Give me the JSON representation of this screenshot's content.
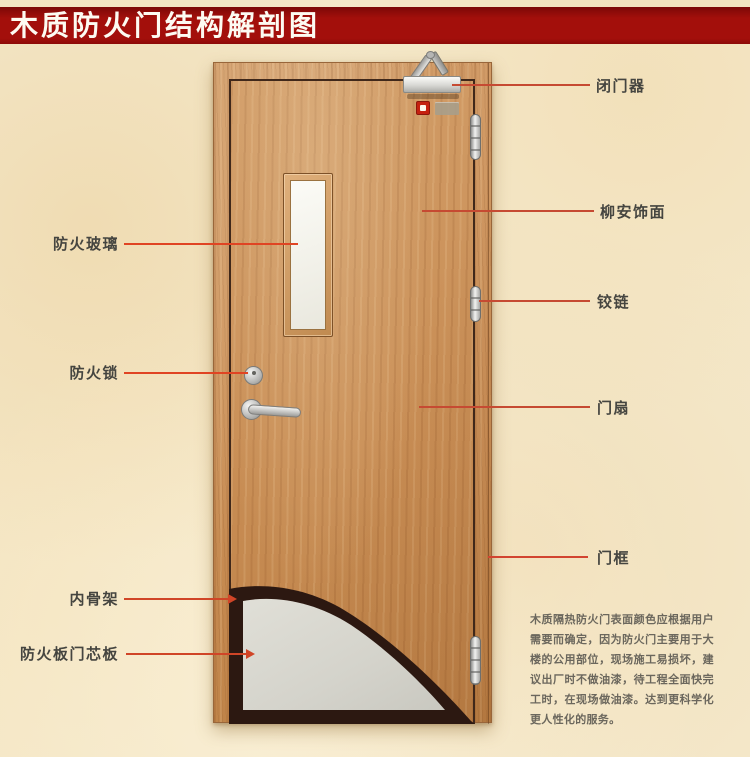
{
  "title": "木质防火门结构解剖图",
  "annotations": {
    "left": [
      {
        "label": "防火玻璃"
      },
      {
        "label": "防火锁"
      },
      {
        "label": "内骨架"
      },
      {
        "label": "防火板门芯板"
      }
    ],
    "right": [
      {
        "label": "闭门器"
      },
      {
        "label": "柳安饰面"
      },
      {
        "label": "铰链"
      },
      {
        "label": "门扇"
      },
      {
        "label": "门框"
      }
    ]
  },
  "description": "木质隔热防火门表面颜色应根据用户需要而确定，因为防火门主要用于大楼的公用部位，现场施工易损坏，建议出厂时不做油漆，待工程全面快完工时，在现场做油漆。达到更科学化更人性化的服务。",
  "colors": {
    "banner_red": "#a30f0b",
    "leader_line": "#d04527",
    "wood": "#cb9058",
    "skeleton_dark": "#2c1811",
    "core_gray": "#d6d5cd",
    "background_parchment": "#f4e8ca"
  }
}
